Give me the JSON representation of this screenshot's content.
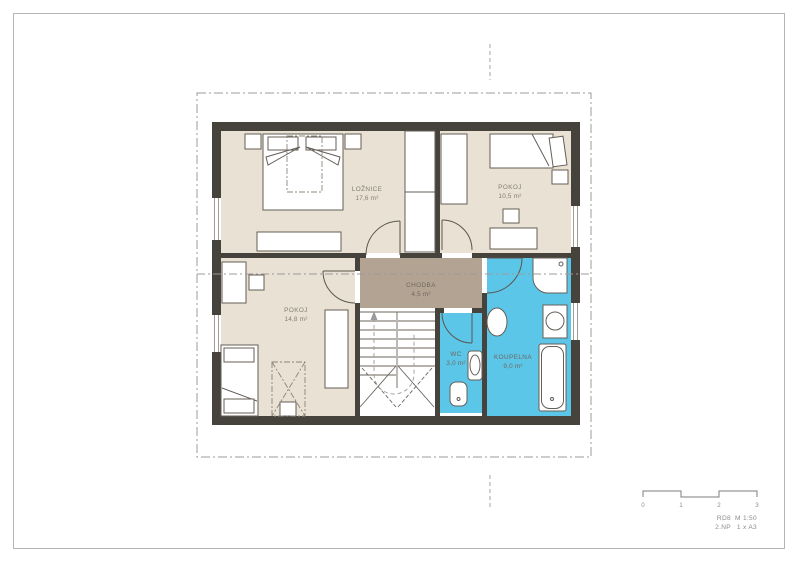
{
  "drawing": {
    "type": "floor-plan",
    "rooms": {
      "loznice": {
        "name": "LOŽNICE",
        "area": "17,6 m²"
      },
      "pokoj_horni": {
        "name": "POKOJ",
        "area": "10,5 m²"
      },
      "pokoj_dolni": {
        "name": "POKOJ",
        "area": "14,8 m²"
      },
      "chodba": {
        "name": "CHODBA",
        "area": "4,5 m²"
      },
      "wc": {
        "name": "WC",
        "area": "3,0 m²"
      },
      "koupelna": {
        "name": "KOUPELNA",
        "area": "9,0 m²"
      }
    },
    "scale_bar": {
      "tick0": "0",
      "tick1": "1",
      "tick2": "2",
      "tick3": "3"
    },
    "title_block": {
      "code": "RD8",
      "scale": "M 1:50",
      "floor": "2.NP",
      "format": "1 x A3"
    },
    "colors": {
      "room_fill": "#e9e1d3",
      "hall_fill": "#b3a392",
      "wet_fill": "#5cc6e9",
      "wall": "#46423c",
      "annotation": "#9b9b9b",
      "text": "#847e75"
    }
  }
}
